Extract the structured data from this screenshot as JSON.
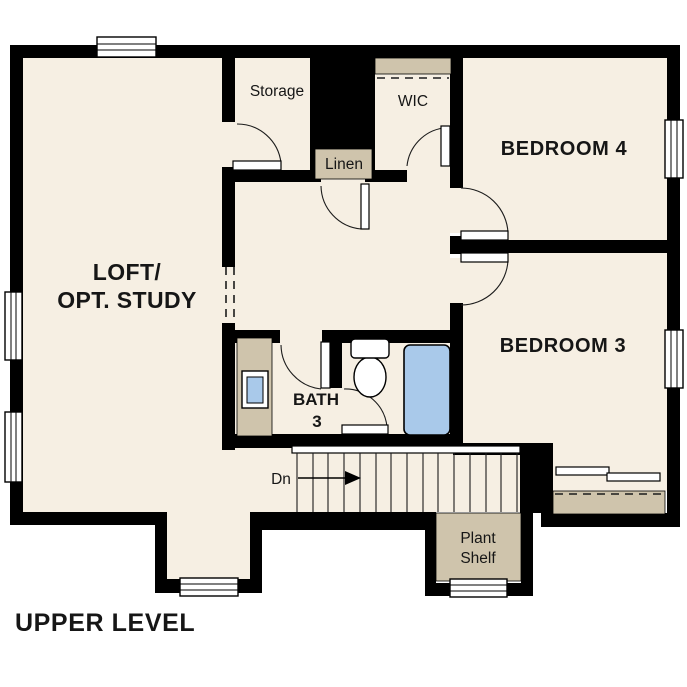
{
  "title": "UPPER LEVEL",
  "colors": {
    "floor": "#f6efe3",
    "wall": "#000000",
    "shelf": "#cfc4ac",
    "fixture_blue": "#a9c9ea"
  },
  "labels": {
    "loft_line1": "LOFT/",
    "loft_line2": "OPT. STUDY",
    "storage": "Storage",
    "wic": "WIC",
    "linen": "Linen",
    "bedroom4": "BEDROOM 4",
    "bedroom3": "BEDROOM 3",
    "bath_line1": "BATH",
    "bath_line2": "3",
    "stairs_direction": "Dn",
    "plant_shelf_line1": "Plant",
    "plant_shelf_line2": "Shelf"
  }
}
